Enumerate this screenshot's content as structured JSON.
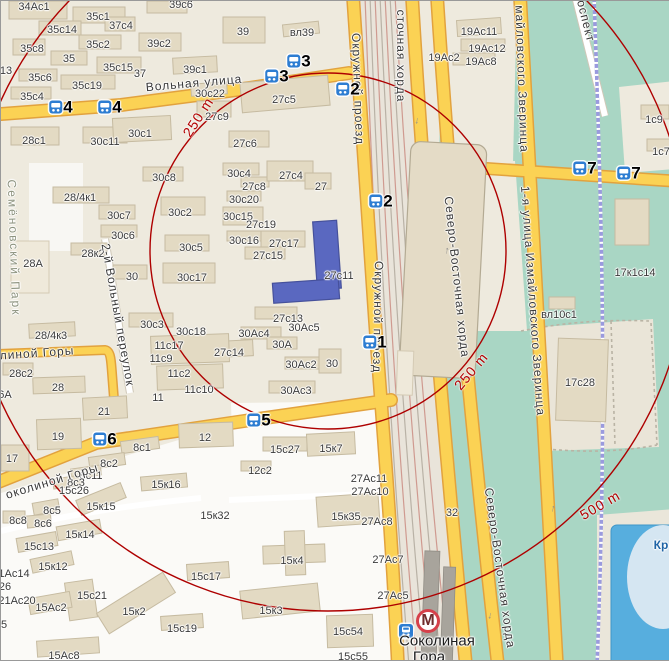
{
  "map_title": "Соколиная Гора район — карта",
  "colors": {
    "base": "#eeeade",
    "block": "#e9e4d6",
    "white_zone": "#fbfaf7",
    "park_green": "#a9d6c4",
    "water_blue": "#57aede",
    "road_yellow": "#fbd254",
    "road_casing": "#e2a23e",
    "building": "#e3dac3",
    "highlight_building": "#5a68c0",
    "circle_red": "#ae0000",
    "marker_blue": "#2d7dd2",
    "metro_red": "#d6404a"
  },
  "circles": {
    "cx": 327,
    "cy": 250,
    "r_250m": 178,
    "r_500m": 360
  },
  "distance_labels": [
    {
      "t": "250 m",
      "x": 197,
      "y": 116,
      "r": -57
    },
    {
      "t": "250 m",
      "x": 470,
      "y": 370,
      "r": -50
    },
    {
      "t": "500 m",
      "x": 599,
      "y": 504,
      "r": -30
    }
  ],
  "markers": [
    {
      "n": "1",
      "x": 366,
      "y": 341
    },
    {
      "n": "2",
      "x": 339,
      "y": 88
    },
    {
      "n": "2",
      "x": 372,
      "y": 200
    },
    {
      "n": "3",
      "x": 290,
      "y": 60
    },
    {
      "n": "3",
      "x": 268,
      "y": 75
    },
    {
      "n": "4",
      "x": 52,
      "y": 106
    },
    {
      "n": "4",
      "x": 101,
      "y": 106
    },
    {
      "n": "5",
      "x": 250,
      "y": 419
    },
    {
      "n": "6",
      "x": 96,
      "y": 438
    },
    {
      "n": "7",
      "x": 576,
      "y": 167
    },
    {
      "n": "7",
      "x": 620,
      "y": 172
    }
  ],
  "metro": {
    "name_line1": "Соколиная",
    "name_line2": "Гора",
    "icon_letter": "М"
  },
  "street_labels": [
    {
      "t": "Вольная улица",
      "x": 193,
      "y": 82,
      "r": -5
    },
    {
      "t": "Окружной проезд",
      "x": 357,
      "y": 88,
      "r": 88
    },
    {
      "t": "Окружной проезд",
      "x": 377,
      "y": 316,
      "r": 91
    },
    {
      "t": "сточная хорда",
      "x": 400,
      "y": 55,
      "r": 90
    },
    {
      "t": "Северо-Восточная хорда",
      "x": 456,
      "y": 276,
      "r": 84
    },
    {
      "t": "Северо-Восточная хорда",
      "x": 499,
      "y": 567,
      "r": 82
    },
    {
      "t": "майловского Зверинца",
      "x": 521,
      "y": 78,
      "r": 88
    },
    {
      "t": "1-я улица Измайловского Зверинца",
      "x": 532,
      "y": 300,
      "r": 86
    },
    {
      "t": "оспект",
      "x": 585,
      "y": 20,
      "r": 76
    },
    {
      "t": "Семёновский Парк",
      "x": 13,
      "y": 247,
      "r": 88,
      "cls": "park"
    },
    {
      "t": "2-й Вольный переулок",
      "x": 117,
      "y": 314,
      "r": 80
    },
    {
      "t": "линой Горы",
      "x": 36,
      "y": 352,
      "r": -4
    },
    {
      "t": "околиной Горы",
      "x": 51,
      "y": 480,
      "r": -17
    },
    {
      "t": "Кр",
      "x": 660,
      "y": 544,
      "r": 0,
      "cls": "water"
    },
    {
      "t": "↓",
      "x": 416,
      "y": 120,
      "r": 8,
      "cls": "arrow"
    },
    {
      "t": "↑",
      "x": 446,
      "y": 250,
      "r": 8,
      "cls": "arrow"
    },
    {
      "t": "↑",
      "x": 552,
      "y": 508,
      "r": 12,
      "cls": "arrow"
    },
    {
      "t": "↓",
      "x": 489,
      "y": 615,
      "r": 10,
      "cls": "arrow"
    }
  ],
  "building_labels": [
    {
      "t": "34Ас1",
      "x": 33,
      "y": 6
    },
    {
      "t": "35с1",
      "x": 97,
      "y": 16
    },
    {
      "t": "37с4",
      "x": 120,
      "y": 25
    },
    {
      "t": "35с14",
      "x": 61,
      "y": 29
    },
    {
      "t": "39с6",
      "x": 180,
      "y": 4
    },
    {
      "t": "35с8",
      "x": 31,
      "y": 48
    },
    {
      "t": "35с2",
      "x": 97,
      "y": 44
    },
    {
      "t": "39с2",
      "x": 158,
      "y": 43
    },
    {
      "t": "35",
      "x": 68,
      "y": 58
    },
    {
      "t": "35с15",
      "x": 117,
      "y": 67
    },
    {
      "t": "37",
      "x": 139,
      "y": 73
    },
    {
      "t": "39с1",
      "x": 194,
      "y": 69
    },
    {
      "t": "35с6",
      "x": 39,
      "y": 77
    },
    {
      "t": "35с19",
      "x": 86,
      "y": 85
    },
    {
      "t": "35с4",
      "x": 31,
      "y": 96
    },
    {
      "t": "13",
      "x": 5,
      "y": 70
    },
    {
      "t": "39",
      "x": 242,
      "y": 31
    },
    {
      "t": "вл39",
      "x": 301,
      "y": 32
    },
    {
      "t": "19Ас11",
      "x": 478,
      "y": 31
    },
    {
      "t": "19Ас12",
      "x": 486,
      "y": 48
    },
    {
      "t": "19Ас8",
      "x": 480,
      "y": 61
    },
    {
      "t": "19Ас2",
      "x": 443,
      "y": 57
    },
    {
      "t": "1с9",
      "x": 653,
      "y": 119
    },
    {
      "t": "1с7",
      "x": 660,
      "y": 151
    },
    {
      "t": "28с1",
      "x": 33,
      "y": 140
    },
    {
      "t": "30с11",
      "x": 104,
      "y": 141
    },
    {
      "t": "30с1",
      "x": 139,
      "y": 133
    },
    {
      "t": "30с22",
      "x": 209,
      "y": 93
    },
    {
      "t": "27с5",
      "x": 283,
      "y": 99
    },
    {
      "t": "27с9",
      "x": 216,
      "y": 116
    },
    {
      "t": "27с6",
      "x": 244,
      "y": 143
    },
    {
      "t": "28/4к1",
      "x": 79,
      "y": 197
    },
    {
      "t": "30с8",
      "x": 163,
      "y": 177
    },
    {
      "t": "30с7",
      "x": 118,
      "y": 215
    },
    {
      "t": "30с2",
      "x": 179,
      "y": 212
    },
    {
      "t": "30с6",
      "x": 122,
      "y": 235
    },
    {
      "t": "28к2",
      "x": 92,
      "y": 253
    },
    {
      "t": "28А",
      "x": 32,
      "y": 263
    },
    {
      "t": "30",
      "x": 131,
      "y": 276
    },
    {
      "t": "30с17",
      "x": 191,
      "y": 277
    },
    {
      "t": "30с3",
      "x": 151,
      "y": 324
    },
    {
      "t": "30с4",
      "x": 238,
      "y": 173
    },
    {
      "t": "27с8",
      "x": 253,
      "y": 186
    },
    {
      "t": "27с4",
      "x": 290,
      "y": 175
    },
    {
      "t": "27",
      "x": 320,
      "y": 186
    },
    {
      "t": "30с20",
      "x": 243,
      "y": 199
    },
    {
      "t": "30с15",
      "x": 237,
      "y": 216
    },
    {
      "t": "27с19",
      "x": 260,
      "y": 224
    },
    {
      "t": "30с16",
      "x": 243,
      "y": 240
    },
    {
      "t": "27с17",
      "x": 283,
      "y": 243
    },
    {
      "t": "30с5",
      "x": 190,
      "y": 247
    },
    {
      "t": "27с15",
      "x": 267,
      "y": 255
    },
    {
      "t": "27с11",
      "x": 338,
      "y": 275
    },
    {
      "t": "28/4к3",
      "x": 50,
      "y": 335
    },
    {
      "t": "30с18",
      "x": 190,
      "y": 331
    },
    {
      "t": "11с17",
      "x": 168,
      "y": 345
    },
    {
      "t": "11с9",
      "x": 160,
      "y": 358
    },
    {
      "t": "11с2",
      "x": 178,
      "y": 373
    },
    {
      "t": "11с10",
      "x": 198,
      "y": 389
    },
    {
      "t": "11",
      "x": 157,
      "y": 397
    },
    {
      "t": "27с14",
      "x": 228,
      "y": 352
    },
    {
      "t": "27с13",
      "x": 287,
      "y": 318
    },
    {
      "t": "30Ас5",
      "x": 303,
      "y": 327
    },
    {
      "t": "30Ас4",
      "x": 253,
      "y": 333
    },
    {
      "t": "30А",
      "x": 281,
      "y": 344
    },
    {
      "t": "30Ас2",
      "x": 300,
      "y": 364
    },
    {
      "t": "30",
      "x": 331,
      "y": 363
    },
    {
      "t": "30Ас3",
      "x": 295,
      "y": 390
    },
    {
      "t": "28с2",
      "x": 20,
      "y": 373
    },
    {
      "t": "28",
      "x": 57,
      "y": 387
    },
    {
      "t": "21",
      "x": 103,
      "y": 411
    },
    {
      "t": "19",
      "x": 57,
      "y": 436
    },
    {
      "t": "17",
      "x": 11,
      "y": 458
    },
    {
      "t": "12",
      "x": 204,
      "y": 437
    },
    {
      "t": "6А",
      "x": 4,
      "y": 394
    },
    {
      "t": "8с1",
      "x": 141,
      "y": 447
    },
    {
      "t": "8с2",
      "x": 108,
      "y": 463
    },
    {
      "t": "8с11",
      "x": 90,
      "y": 475
    },
    {
      "t": "8с3",
      "x": 75,
      "y": 482
    },
    {
      "t": "15с26",
      "x": 73,
      "y": 490
    },
    {
      "t": "8с5",
      "x": 51,
      "y": 510
    },
    {
      "t": "8с8",
      "x": 17,
      "y": 520
    },
    {
      "t": "8с6",
      "x": 42,
      "y": 523
    },
    {
      "t": "15к15",
      "x": 100,
      "y": 506
    },
    {
      "t": "15к14",
      "x": 79,
      "y": 534
    },
    {
      "t": "15с13",
      "x": 38,
      "y": 546
    },
    {
      "t": "15к12",
      "x": 52,
      "y": 566
    },
    {
      "t": "15к16",
      "x": 165,
      "y": 484
    },
    {
      "t": "15с27",
      "x": 284,
      "y": 449
    },
    {
      "t": "15к7",
      "x": 330,
      "y": 448
    },
    {
      "t": "12с2",
      "x": 259,
      "y": 470
    },
    {
      "t": "27Ас11",
      "x": 368,
      "y": 478
    },
    {
      "t": "27Ас10",
      "x": 369,
      "y": 491
    },
    {
      "t": "15к32",
      "x": 214,
      "y": 515
    },
    {
      "t": "32",
      "x": 451,
      "y": 512
    },
    {
      "t": "15к35",
      "x": 345,
      "y": 516
    },
    {
      "t": "27Ас8",
      "x": 376,
      "y": 521
    },
    {
      "t": "27Ас7",
      "x": 387,
      "y": 559
    },
    {
      "t": "27Ас5",
      "x": 392,
      "y": 595
    },
    {
      "t": "15к2",
      "x": 133,
      "y": 611
    },
    {
      "t": "15с21",
      "x": 91,
      "y": 595
    },
    {
      "t": "15Ас2",
      "x": 50,
      "y": 607
    },
    {
      "t": "15с17",
      "x": 205,
      "y": 576
    },
    {
      "t": "15с19",
      "x": 181,
      "y": 628
    },
    {
      "t": "15к3",
      "x": 270,
      "y": 610
    },
    {
      "t": "15к4",
      "x": 291,
      "y": 560
    },
    {
      "t": "15с54",
      "x": 347,
      "y": 631
    },
    {
      "t": "15с55",
      "x": 352,
      "y": 656
    },
    {
      "t": "15Ас8",
      "x": 63,
      "y": 655
    },
    {
      "t": "21Ас20",
      "x": 16,
      "y": 600
    },
    {
      "t": "1Ас14",
      "x": 13,
      "y": 573
    },
    {
      "t": "26",
      "x": 4,
      "y": 586
    },
    {
      "t": "5",
      "x": 3,
      "y": 624
    },
    {
      "t": "17с28",
      "x": 579,
      "y": 382
    },
    {
      "t": "17к1с14",
      "x": 634,
      "y": 272
    },
    {
      "t": "вл10с1",
      "x": 558,
      "y": 314
    }
  ]
}
